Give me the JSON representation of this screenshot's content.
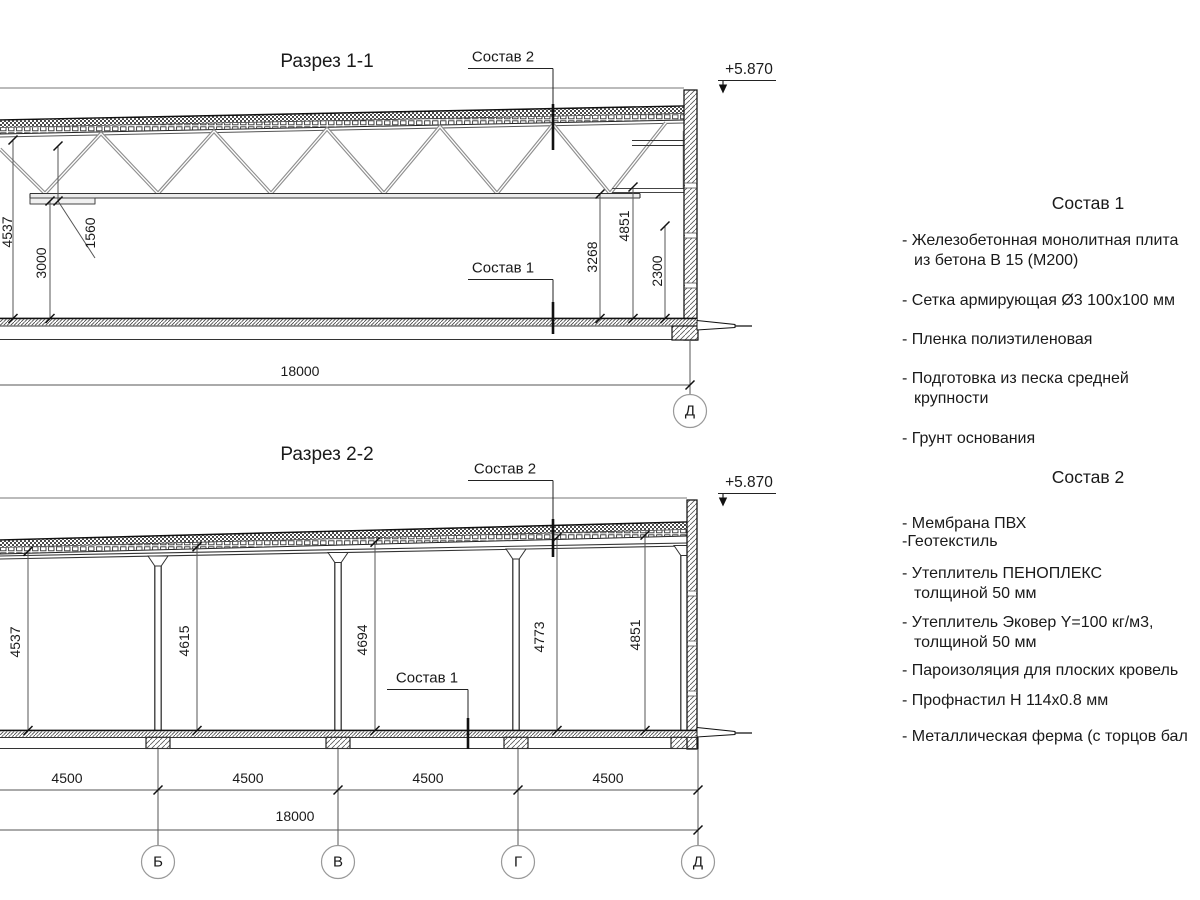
{
  "colors": {
    "line": "#1a1a1a",
    "truss": "#8f8f8f",
    "dimension": "#555555",
    "background": "#ffffff"
  },
  "drawing1": {
    "title": "Разрез 1-1",
    "callout_top": "Состав 2",
    "callout_bottom": "Состав 1",
    "elevation": "+5.870",
    "dim_overall": "18000",
    "dims": {
      "height_left": "4537",
      "truss_depth": "1560",
      "clear_height_left": "3000",
      "clear_height_right": "3268",
      "height_right": "4851",
      "wall_panel": "2300"
    },
    "grid_label": "Д"
  },
  "drawing2": {
    "title": "Разрез 2-2",
    "callout_top": "Состав 2",
    "callout_bottom": "Состав 1",
    "elevation": "+5.870",
    "dim_overall": "18000",
    "bay_dims": [
      "4500",
      "4500",
      "4500",
      "4500"
    ],
    "heights": [
      "4537",
      "4615",
      "4694",
      "4773",
      "4851"
    ],
    "grid_labels": [
      "Б",
      "В",
      "Г",
      "Д"
    ]
  },
  "legend1": {
    "title": "Состав 1",
    "items": [
      "- Железобетонная  монолитная плита\nиз бетона В 15 (М200)",
      "- Сетка армирующая Ø3 100x100 мм",
      "- Пленка полиэтиленовая",
      "- Подготовка из песка средней\nкрупности",
      "- Грунт основания"
    ]
  },
  "legend2": {
    "title": "Состав 2",
    "items": [
      "- Мембрана ПВХ",
      "-Геотекстиль",
      "- Утеплитель ПЕНОПЛЕКС\nтолщиной 50 мм",
      "- Утеплитель Эковер Y=100 кг/м3,\nтолщиной 50 мм",
      "- Пароизоляция для плоских кровель",
      "- Профнастил Н 114x0.8 мм",
      "- Металлическая ферма (с торцов бал"
    ]
  }
}
